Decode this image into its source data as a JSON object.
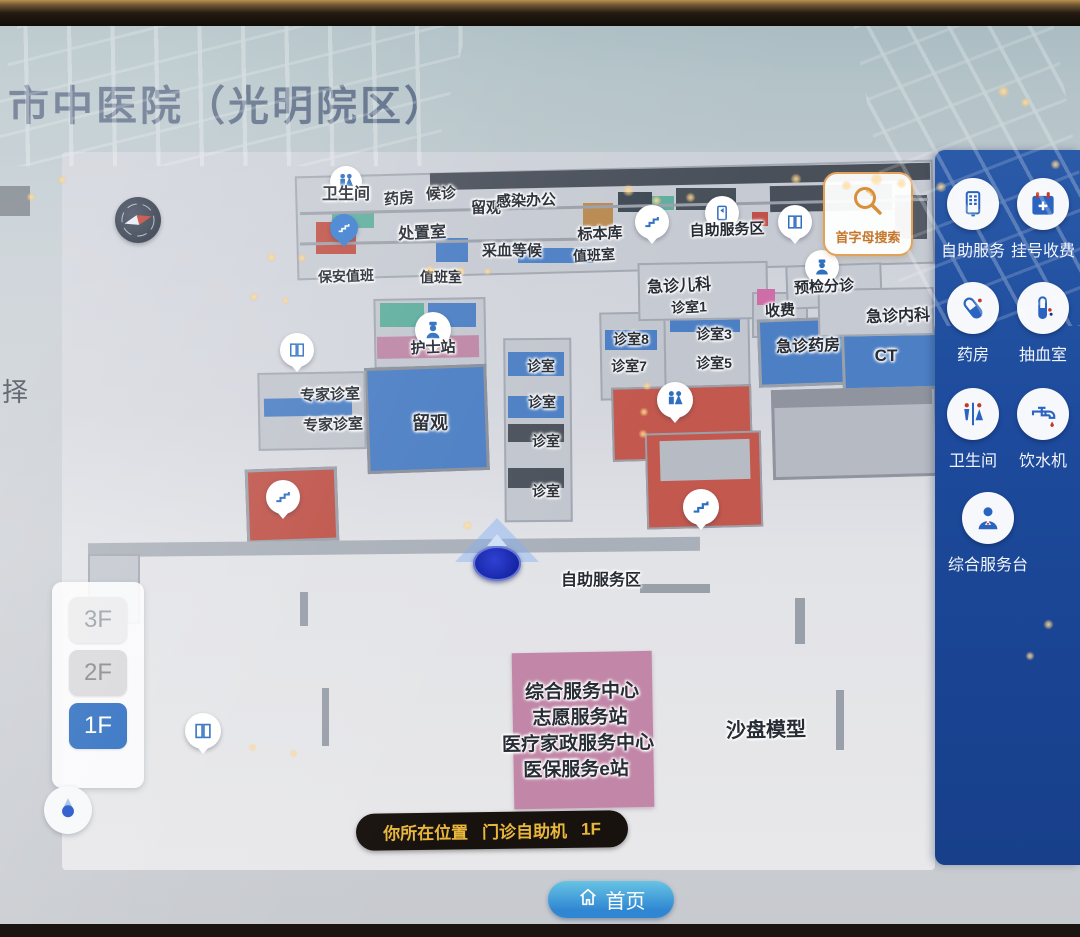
{
  "title": "市中医院（光明院区）",
  "left_edge_text": "择",
  "search_button": {
    "label": "首字母搜索"
  },
  "floor_selector": {
    "floors": [
      {
        "label": "3F",
        "active": false
      },
      {
        "label": "2F",
        "active": false
      },
      {
        "label": "1F",
        "active": true
      }
    ]
  },
  "location_pill": {
    "prefix": "你所在位置",
    "location": "门诊自助机",
    "floor": "1F"
  },
  "home_button": {
    "label": "首页"
  },
  "sidebar": {
    "items": [
      {
        "label": "自助服务",
        "icon": "kiosk-icon"
      },
      {
        "label": "挂号收费",
        "icon": "calendar-plus-icon"
      },
      {
        "label": "药房",
        "icon": "capsule-icon"
      },
      {
        "label": "抽血室",
        "icon": "test-tube-icon"
      },
      {
        "label": "卫生间",
        "icon": "restroom-icon"
      },
      {
        "label": "饮水机",
        "icon": "water-faucet-icon"
      },
      {
        "label": "综合服务台",
        "icon": "concierge-icon"
      }
    ]
  },
  "map": {
    "labels": [
      "卫生间",
      "药房",
      "候诊",
      "留观",
      "感染办公",
      "处置室",
      "标本库",
      "采血等候",
      "值班室",
      "自助服务区",
      "保安值班",
      "值班室",
      "急诊儿科",
      "预检分诊",
      "诊室1",
      "收费",
      "急诊内科",
      "护士站",
      "诊室8",
      "诊室3",
      "急诊药房",
      "CT",
      "诊室",
      "诊室7",
      "诊室5",
      "专家诊室",
      "专家诊室",
      "留观",
      "诊室",
      "诊室",
      "诊室",
      "自助服务区",
      "沙盘模型"
    ],
    "pink_block_lines": [
      "综合服务中心",
      "志愿服务站",
      "医疗家政服务中心",
      "医保服务e站"
    ]
  },
  "colors": {
    "sidebar_bg": "#1d4a9c",
    "accent_orange": "#d88f3a",
    "floor_active": "#2f6fc1",
    "pill_bg": "#17120e",
    "pill_text": "#e8b63c",
    "map_blue_room": "#4c7fc4",
    "map_red_room": "#c3584e",
    "map_pink_room": "#c287a8",
    "map_teal_room": "#5fae9f",
    "location_marker": "#1c2bb8"
  }
}
